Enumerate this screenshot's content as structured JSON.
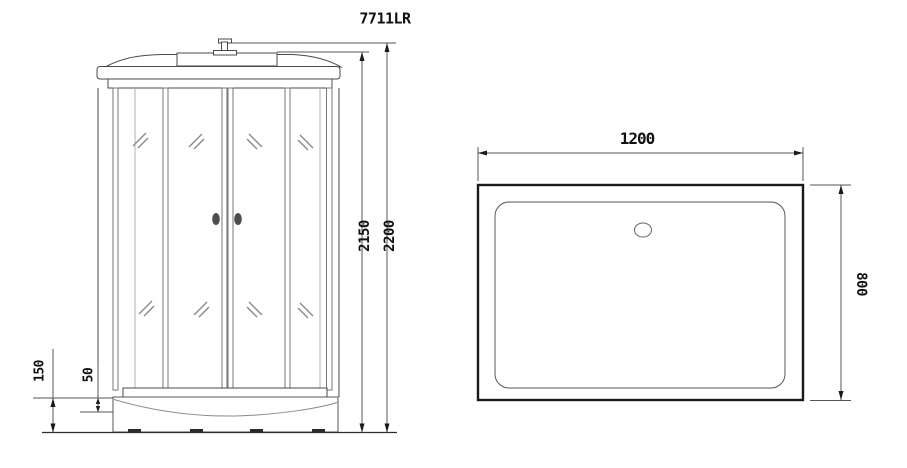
{
  "model": "7711LR",
  "front_view": {
    "height_inner": "2150",
    "height_total": "2200",
    "base_height": "150",
    "rim_height": "50"
  },
  "top_view": {
    "width": "1200",
    "depth": "800"
  },
  "colors": {
    "outline": "#4a4a4a",
    "dim_line": "#555555",
    "dark_line": "#2a2a2a",
    "glass_mark": "#8a8a8a",
    "handle": "#4d4d4d",
    "background": "#ffffff"
  }
}
